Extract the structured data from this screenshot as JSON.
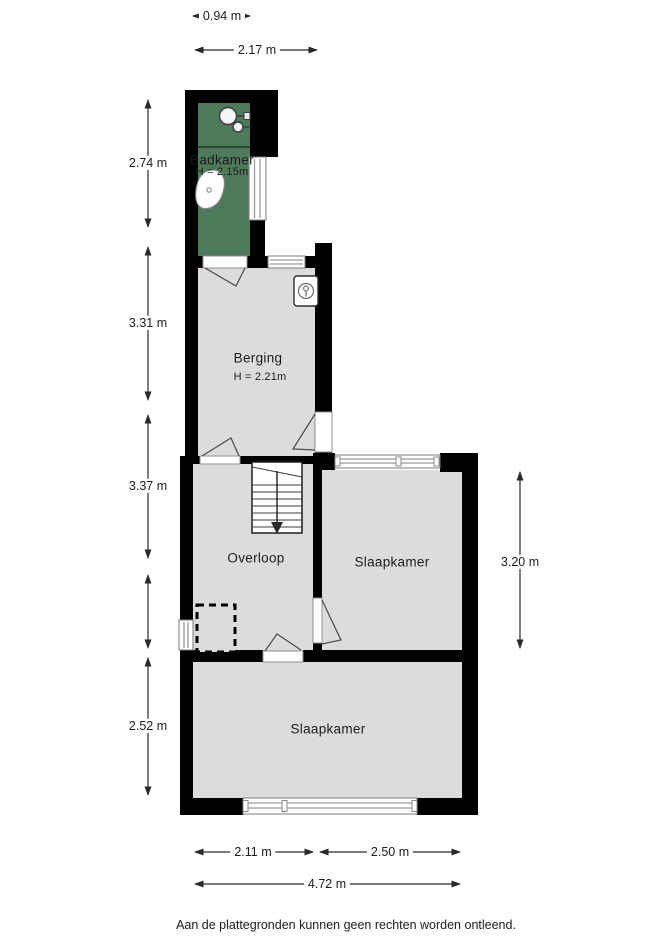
{
  "colors": {
    "wall": "#000000",
    "room_fill": "#dcdcdc",
    "bathroom_fill": "#4e7a5c",
    "dim_line": "#2a2a2a",
    "text": "#1c1c1c"
  },
  "rooms": {
    "badkamer": {
      "label": "Badkamer",
      "height_label": "H = 2.15m"
    },
    "berging": {
      "label": "Berging",
      "height_label": "H = 2.21m"
    },
    "overloop": {
      "label": "Overloop"
    },
    "slaapkamer_rechts": {
      "label": "Slaapkamer"
    },
    "slaapkamer_onder": {
      "label": "Slaapkamer"
    }
  },
  "fixtures": {
    "shower": "shower-mixer-icon",
    "toilet": "toilet-icon",
    "boiler": "boiler-icon",
    "stairs": "stairs-down-icon",
    "hatch": "dashed-hatch-outline"
  },
  "dimensions": {
    "top_badkamer_width": "0.94 m",
    "top_berging_width": "2.17 m",
    "left_badkamer": "2.74 m",
    "left_berging": "3.31 m",
    "left_overloop": "3.37 m",
    "left_slaapkamer": "2.52 m",
    "right_slaapkamer": "3.20 m",
    "bottom_left": "2.11 m",
    "bottom_right": "2.50 m",
    "bottom_total": "4.72 m"
  },
  "footer": {
    "disclaimer": "Aan de plattegronden kunnen geen rechten worden ontleend."
  }
}
